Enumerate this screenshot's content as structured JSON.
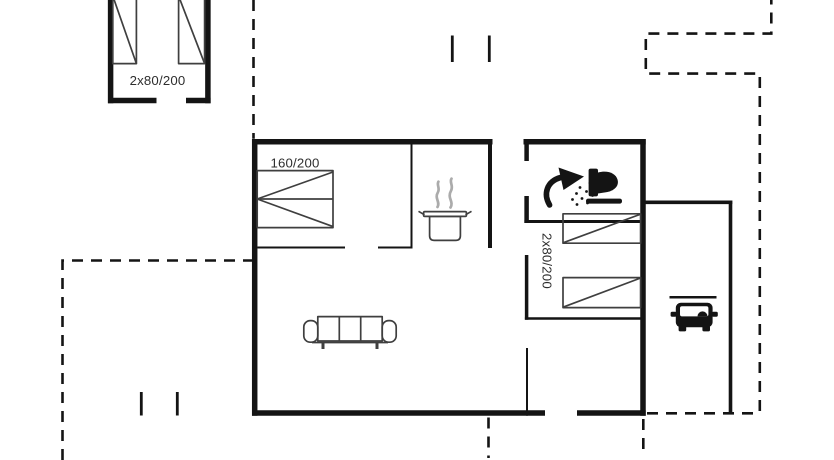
{
  "plan": {
    "labels": {
      "annex_beds": "2x80/200",
      "main_double_bed": "160/200",
      "right_twin_beds": "2x80/200"
    },
    "icons": {
      "kitchen": "cooking-pot-icon",
      "bathroom_shower": "shower-icon",
      "bathroom_toilet": "toilet-icon",
      "carport": "car-icon",
      "beds": "bed-symbol",
      "living": "sofa-symbol"
    },
    "colors": {
      "wall": "#141414",
      "furniture_line": "#3f3f3f",
      "steam": "#ababab",
      "label_text": "#2e2e2e"
    }
  }
}
